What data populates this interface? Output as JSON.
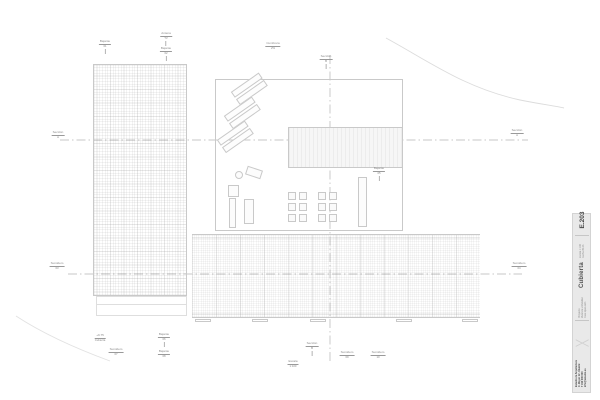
{
  "colors": {
    "paper": "#ffffff",
    "line": "#c9c9c9",
    "line_faint": "#dedede",
    "section_line": "#b5b5b5",
    "annotation": "#8a8a8a",
    "titleblock_bg": "#e9e9e9",
    "titleblock_text": "#555555"
  },
  "drawing": {
    "annotations": [
      {
        "text": "Bajante",
        "sub": "01",
        "x": 105,
        "y": 40,
        "leader": "v"
      },
      {
        "text": "Antena",
        "sub": "TV",
        "x": 166,
        "y": 32,
        "leader": "v"
      },
      {
        "text": "Bajante",
        "sub": "02",
        "x": 166,
        "y": 47,
        "leader": "v"
      },
      {
        "text": "Cumbrera",
        "sub": "2%",
        "x": 273,
        "y": 42,
        "leader": "none"
      },
      {
        "text": "Sección",
        "sub": "B",
        "x": 326,
        "y": 55,
        "leader": "v"
      },
      {
        "text": "Sección",
        "sub": "A",
        "x": 58,
        "y": 131,
        "leader": "none"
      },
      {
        "text": "Sección",
        "sub": "A",
        "x": 517,
        "y": 129,
        "leader": "none"
      },
      {
        "text": "Sumidero",
        "sub": "03",
        "x": 57,
        "y": 262,
        "leader": "none"
      },
      {
        "text": "Sumidero",
        "sub": "04",
        "x": 519,
        "y": 262,
        "leader": "none"
      },
      {
        "text": "Bajante",
        "sub": "05",
        "x": 379,
        "y": 167,
        "leader": "v"
      },
      {
        "text": "+9.75",
        "sub": "Cubierta",
        "x": 100,
        "y": 334,
        "leader": "none"
      },
      {
        "text": "Bajante",
        "sub": "06",
        "x": 164,
        "y": 333,
        "leader": "v"
      },
      {
        "text": "Sumidero",
        "sub": "07",
        "x": 116,
        "y": 348,
        "leader": "none"
      },
      {
        "text": "Bajante",
        "sub": "08",
        "x": 164,
        "y": 350,
        "leader": "none"
      },
      {
        "text": "Sección",
        "sub": "B",
        "x": 312,
        "y": 342,
        "leader": "v"
      },
      {
        "text": "Sumidero",
        "sub": "09",
        "x": 347,
        "y": 351,
        "leader": "none"
      },
      {
        "text": "Sumidero",
        "sub": "10",
        "x": 378,
        "y": 351,
        "leader": "none"
      },
      {
        "text": "Escala",
        "sub": "1:100",
        "x": 293,
        "y": 360,
        "leader": "none"
      }
    ]
  },
  "titleblock": {
    "sheet_code": "E.203",
    "title": "Cubierta",
    "project_fields": "Proyecto\nVivienda unifamiliar\nFase  Ejecución",
    "meta_fields": "Escala  1:100\nFecha  05.23",
    "firm_info": "Estudio de Arquitectura\nC. Mayor 12 · Madrid\nT 910 000 000\ninfo@estudio.es",
    "logo_glyph": "╳"
  }
}
